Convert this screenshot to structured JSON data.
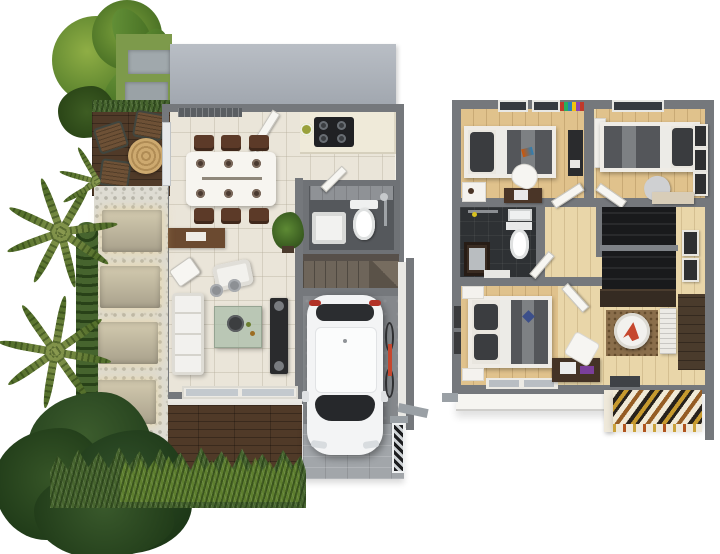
{
  "scene": {
    "title": "3D two-storey house floor plan render, top view",
    "views": [
      {
        "id": "first-floor",
        "label": "Ground floor with garden, patio, garage and driveway"
      },
      {
        "id": "second-floor",
        "label": "Second floor with three bedrooms, bathroom and stair hall"
      }
    ]
  },
  "first_floor": {
    "rooms": [
      "patio deck",
      "dining area",
      "kitchen",
      "bathroom",
      "staircase",
      "living room",
      "garage",
      "driveway",
      "gravel garden path"
    ],
    "furniture": [
      "outdoor table with three wooden chairs",
      "dining table with six chairs and place settings",
      "kitchen counter with black cooktop",
      "air-conditioner unit",
      "wooden sideboard",
      "toilet and washbasin",
      "potted plant",
      "white sofa",
      "white armchair",
      "glass coffee table",
      "tv cabinet with speakers",
      "sliding glass doors",
      "white car",
      "bicycle",
      "louvered side gate"
    ]
  },
  "second_floor": {
    "rooms": [
      "bedroom one",
      "bedroom two",
      "bathroom",
      "hallway",
      "stairwell",
      "master bedroom",
      "family sitting area"
    ],
    "furniture": [
      "single bed with dark bedding",
      "white desk chair and dark desk",
      "wardrobe with sliding doors",
      "single bed with dark pillow",
      "three wall frames",
      "toilet, wall basin and dark vanity",
      "double bed with blue accent pillow",
      "two white nightstands",
      "round white table with red cloth on brown rug",
      "slatted white bench",
      "study desk",
      "striped slat canopy over entrance"
    ]
  },
  "landscape": {
    "items": [
      "broadleaf ornamental plants",
      "stepping-stone walkway on grass",
      "palm shrubs",
      "gravel path with glowing stone pavers",
      "clipped hedge strips",
      "large dark green tree",
      "grass border hedge"
    ]
  },
  "palette": {
    "wall": "#75787c",
    "roof": "#aeb4bc",
    "tile": "#eae5d9",
    "counter": "#efead9",
    "woodFloor": "#e0c28c",
    "hallFloor": "#e9d6a9",
    "deck": "#503a28",
    "drive": "#a2a6aa",
    "garage": "#85888c",
    "bath1": "#55585c",
    "bath2": "#2e3134",
    "stairs1": "#6e655a",
    "stairsDark": "#191a1c",
    "grass": "#7d9a4b",
    "hedge": "#46642e",
    "tree": "#2e4724",
    "palm": "#74873f",
    "gravel": "#dedcd3",
    "car": "#f3f4f5",
    "sofa": "#f2f1ee",
    "bedding": "#54565a",
    "pillow": "#3a3c3f",
    "tableWhite": "#f7f5f0",
    "chairBrown": "#5c3a28",
    "sideboard": "#6b4a30",
    "cabinetDark": "#2a2b2d",
    "rug": "#8a6e4b",
    "accentRed": "#c6472e",
    "accentBlue": "#3c4f8a",
    "canopyGold": "#c79a2e",
    "glassPane": "#c3c9ce",
    "cooktop": "#202124",
    "taillight": "#b23227"
  }
}
